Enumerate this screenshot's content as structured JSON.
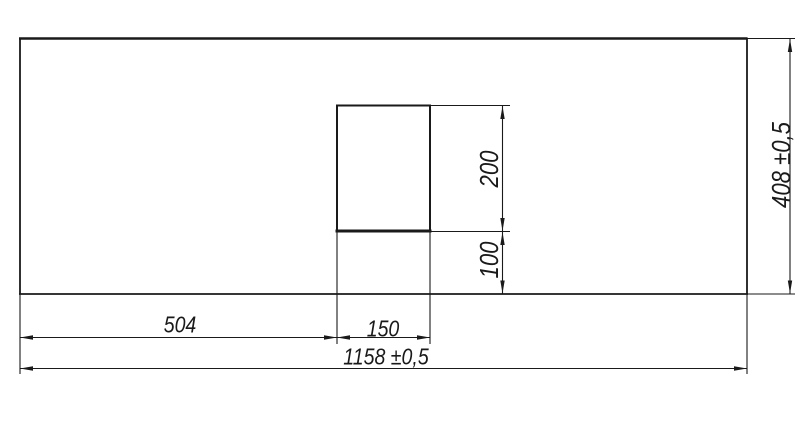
{
  "drawing": {
    "background_color": "#ffffff",
    "line_color": "#1a1a1a",
    "panel": {
      "total_width_label": "1158 ±0,5",
      "total_height_label": "408 ±0,5"
    },
    "cutout": {
      "offset_from_left_label": "504",
      "width_label": "150",
      "height_label": "200",
      "distance_to_bottom_label": "100"
    }
  }
}
